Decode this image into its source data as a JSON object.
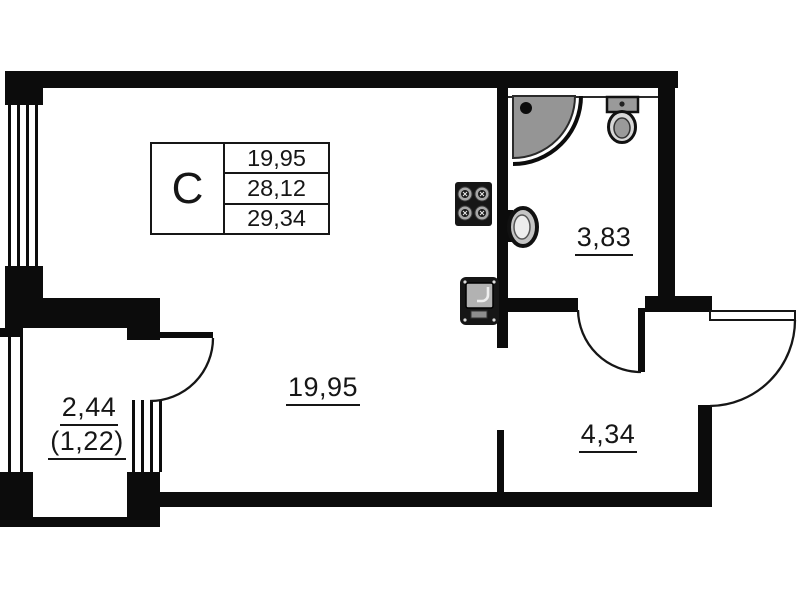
{
  "title": "studio-apartment-floor-plan",
  "colors": {
    "wall": "#0c0c0c",
    "line": "#161616",
    "fixture_dark": "#161616",
    "fixture_gray": "#a0a0a0",
    "shower_gray": "#959595",
    "background": "#ffffff"
  },
  "legend": {
    "type_label": "C",
    "rows": [
      "19,95",
      "28,12",
      "29,34"
    ]
  },
  "rooms": {
    "living": {
      "label": "19,95"
    },
    "bathroom": {
      "label": "3,83"
    },
    "hallway": {
      "label": "4,34"
    },
    "balcony": {
      "label_total": "2,44",
      "label_reduced": "(1,22)"
    }
  },
  "icons": {
    "shower": "corner-shower-icon",
    "toilet": "toilet-icon",
    "wash_basin": "wash-basin-icon",
    "stove": "stove-4-burner-icon",
    "kitchen_sink": "kitchen-sink-icon",
    "doors": [
      "balcony-door-swing",
      "bathroom-door-swing",
      "entry-door-swing"
    ],
    "windows": [
      "living-room-window",
      "balcony-side-window",
      "balcony-glazing"
    ]
  }
}
